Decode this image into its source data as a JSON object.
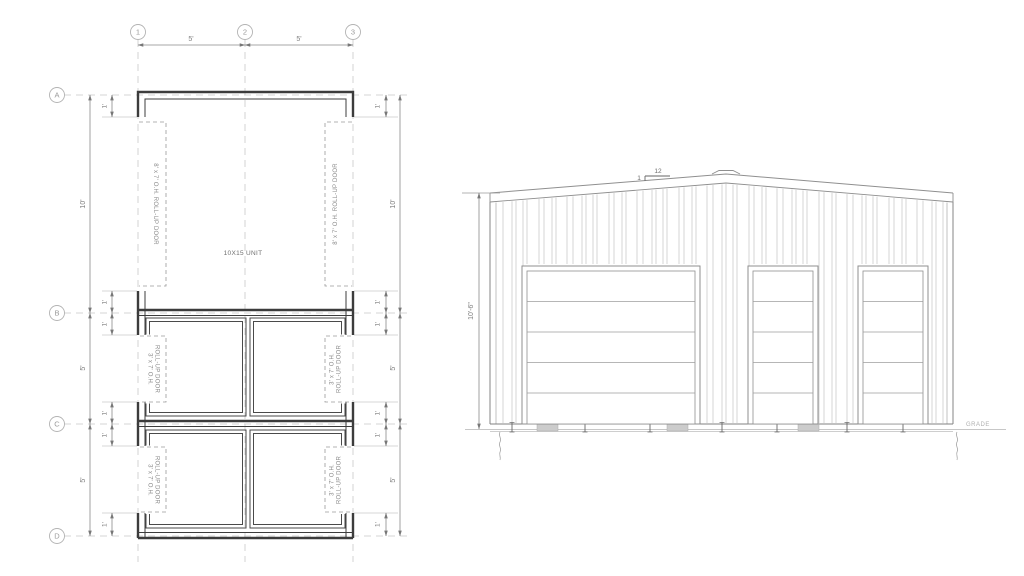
{
  "drawing": {
    "plan": {
      "title_unit": "10X15 UNIT",
      "grid_cols": [
        "1",
        "2",
        "3"
      ],
      "grid_rows": [
        "A",
        "B",
        "C",
        "D"
      ],
      "dim_top": [
        "5'",
        "5'"
      ],
      "dim_left": [
        "10'",
        "5'",
        "5'"
      ],
      "dim_right": [
        "10'",
        "5'",
        "5'"
      ],
      "dim_one_foot": "1'",
      "door_large_label": "8' x 7' O.H. ROLL-UP DOOR",
      "door_small_line1": "3' x 7' O.H.",
      "door_small_line2": "ROLL-UP DOOR"
    },
    "elevation": {
      "height_dim": "10'-6\"",
      "slope_rise": "1",
      "slope_run": "12",
      "grade_label": "GRADE"
    },
    "colors": {
      "wall": "#3c3c3c",
      "line_light": "#9a9a9a",
      "grid_dash": "#c9c9c9",
      "pad_fill": "#cccccc"
    }
  }
}
